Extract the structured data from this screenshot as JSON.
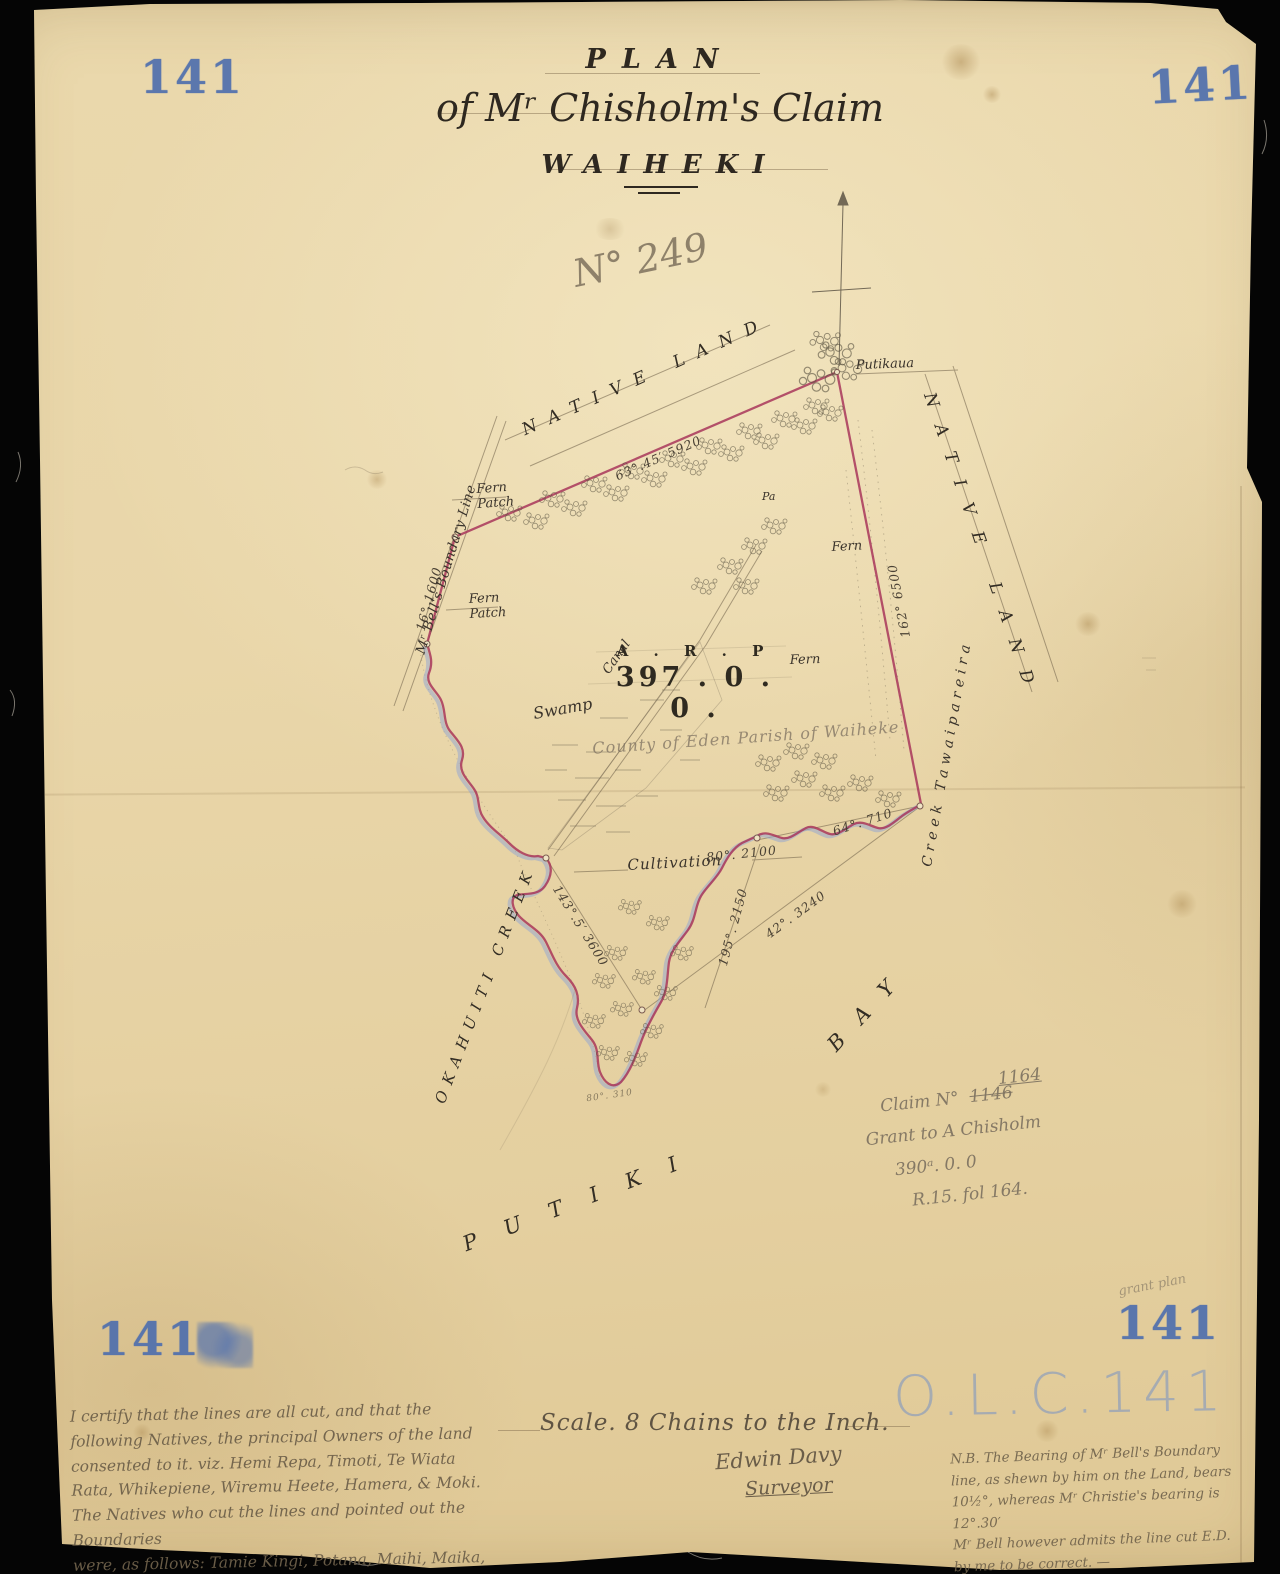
{
  "colors": {
    "stamp_blue": "#4f6fae",
    "boundary_red": "#a8365a",
    "water_blue": "#8fa3d4",
    "paper": "#e8d5a8"
  },
  "stamps": {
    "number": "141",
    "olc": "O.L.C.141"
  },
  "title": {
    "line1": "PLAN",
    "line2": "of Mʳ Chisholm's Claim",
    "line3": "WAIHEKI"
  },
  "annotations": {
    "pencil_number": "N° 249",
    "county_note": "County of Eden Parish of Waiheke",
    "claim_prefix": "Claim N°",
    "claim_old": "1146",
    "claim_new": "1164",
    "grant_note": "Grant to A Chisholm",
    "area_note": "390ᵃ. 0. 0",
    "folio_note": "R.15. fol 164.",
    "corner_note": "grant plan"
  },
  "map": {
    "labels": {
      "native_land_top": "NATIVE LAND",
      "native_land_right": "NATIVE LAND",
      "bells_boundary": "Mʳ Bell's Boundary Line",
      "okahuiti_creek": "OKAHUITI CREEK",
      "putiki": "PUTIKI",
      "bay": "BAY",
      "creek_tawaipareira": "Creek  Tawaipareira",
      "fern_patch_upper": "Fern Patch",
      "fern_patch_lower": "Fern Patch",
      "fern_upper": "Fern",
      "fern_lower": "Fern",
      "pa": "Pa",
      "swamp": "Swamp",
      "canal": "Canal",
      "cultivation": "Cultivation",
      "putikaua": "Putikaua"
    },
    "area": {
      "header": "A . R . P",
      "value": "397 . 0 . 0 ."
    },
    "bearings": {
      "top": "63°.45′  5920",
      "bell": "16°  1600",
      "east": "162°  6500",
      "creek": "80°. 2100",
      "corner": "64°. 710",
      "swamp_tie": "143°.5′  3600",
      "shore": "195°. 2150",
      "bay_tie": "42°. 3240",
      "tip": "80°. 310"
    }
  },
  "scale": {
    "text": "Scale. 8 Chains to the Inch.",
    "signature": "Edwin Davy",
    "role": "Surveyor"
  },
  "certification": {
    "lines": [
      "I certify that the lines are all cut, and that the",
      "following Natives, the principal Owners of the land",
      "consented to it. viz. Hemi Repa, Timoti, Te Wiata",
      "Rata, Whikepiene, Wiremu Heete, Hamera, & Moki.",
      "The Natives who cut the lines and pointed out the Boundaries",
      "were, as follows: Tamie Kingi, Potana, Maihi, Maika,",
      "Maheke, & Honi. —"
    ],
    "signature": "Edwin Davy",
    "role": "Surveyor."
  },
  "nb_note": {
    "lines": [
      "N.B. The Bearing of Mʳ Bell's Boundary",
      "line, as shewn by him on the Land, bears",
      "10½°, whereas Mʳ Christie's bearing is 12°.30′",
      "Mʳ Bell however admits the line cut E.D.",
      "by me to be correct. —"
    ]
  }
}
